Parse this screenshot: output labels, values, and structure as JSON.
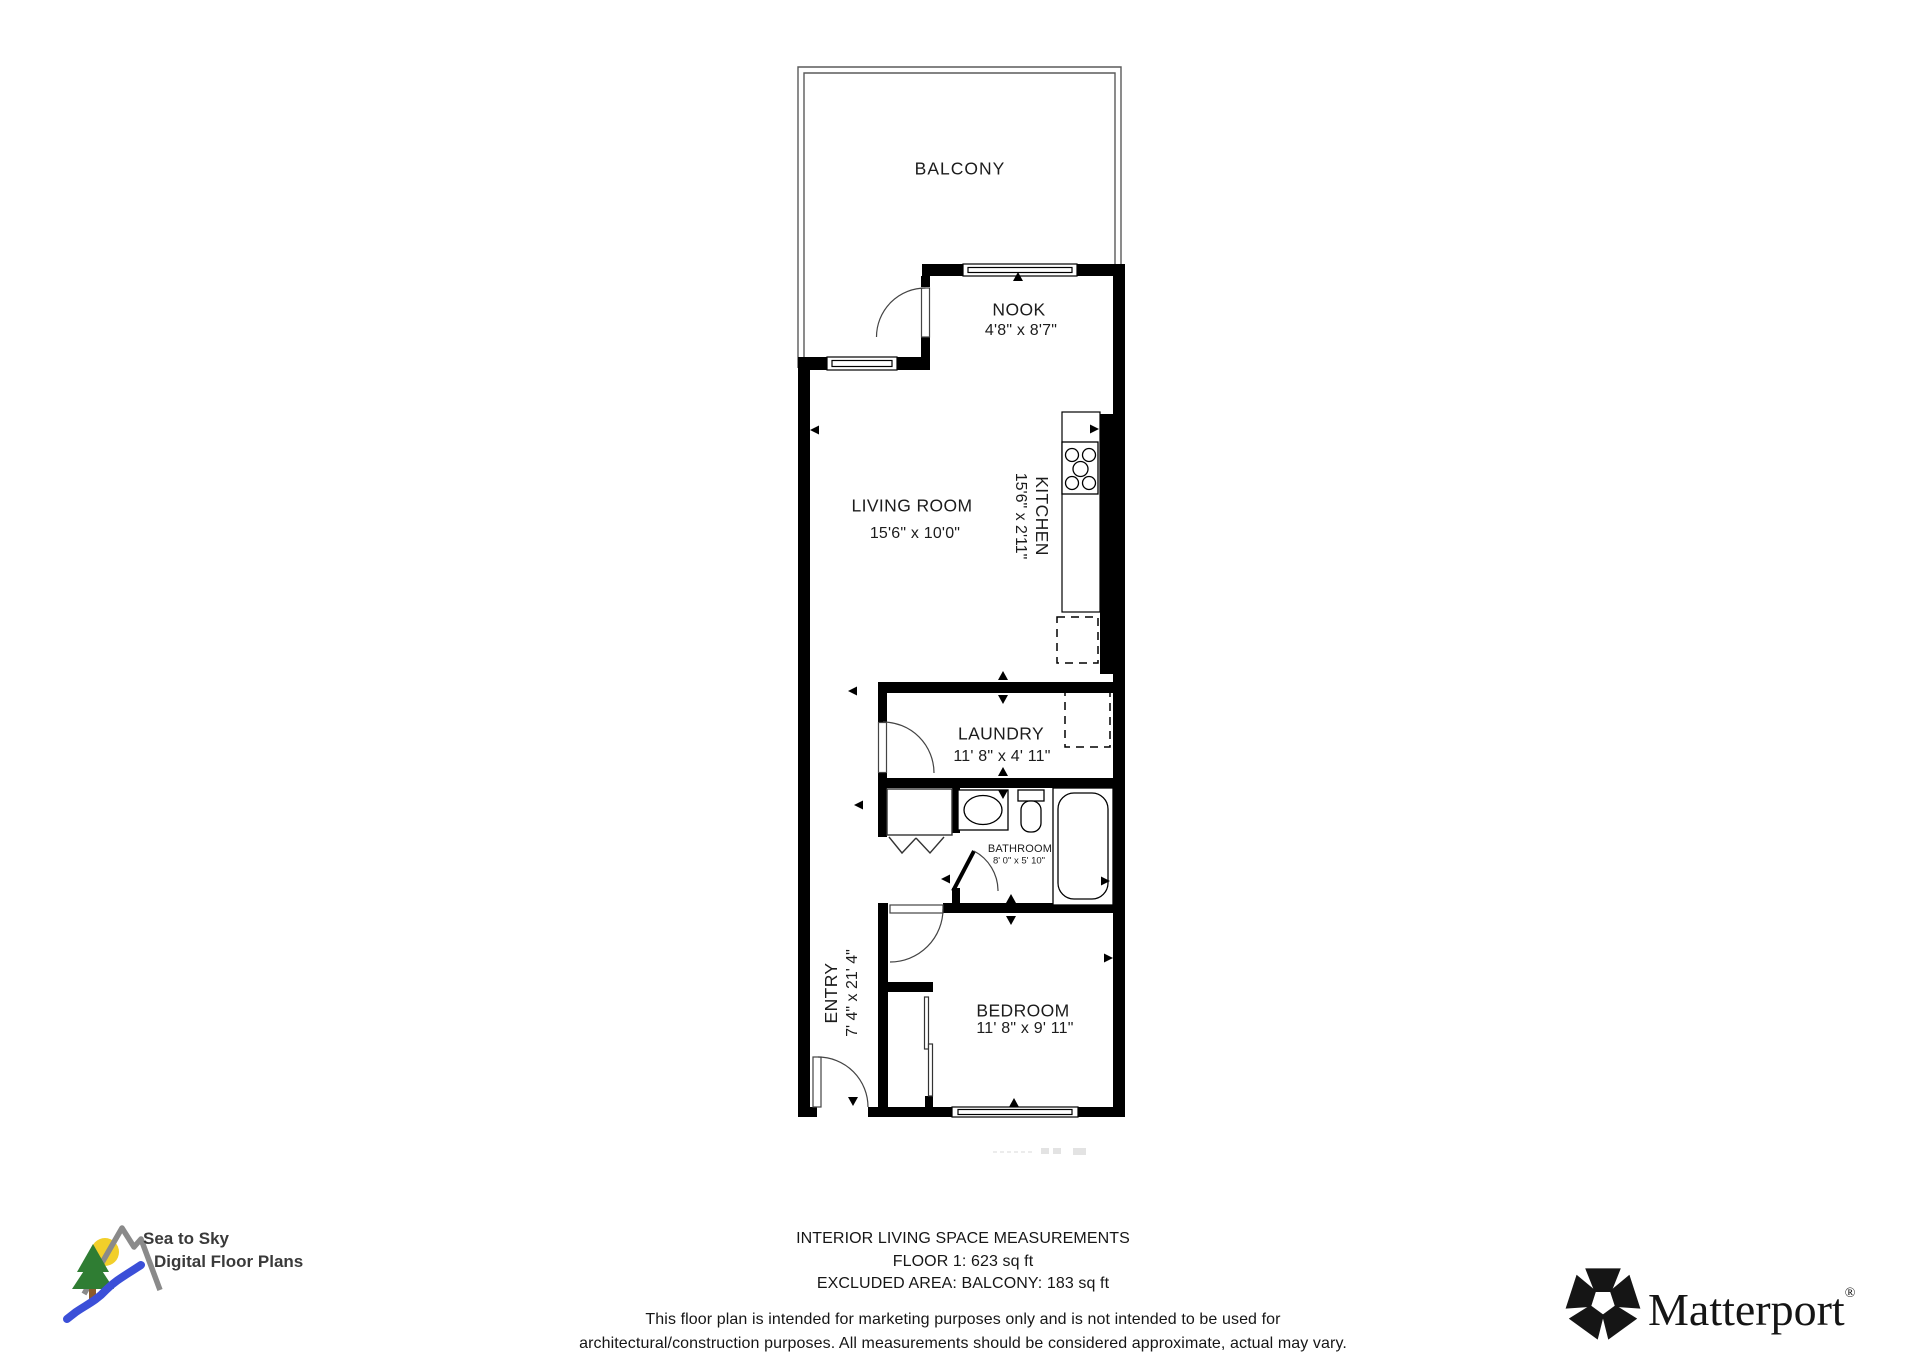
{
  "rooms": [
    {
      "name": "BALCONY",
      "dims": ""
    },
    {
      "name": "NOOK",
      "dims": "4'8\" x 8'7\""
    },
    {
      "name": "LIVING ROOM",
      "dims": "15'6\" x 10'0\""
    },
    {
      "name": "KITCHEN",
      "dims": "15'6\" x 2'11\""
    },
    {
      "name": "LAUNDRY",
      "dims": "11' 8\" x 4' 11\""
    },
    {
      "name": "BATHROOM",
      "dims": "8' 0\" x 5' 10\""
    },
    {
      "name": "ENTRY",
      "dims": "7' 4\" x 21' 4\""
    },
    {
      "name": "BEDROOM",
      "dims": "11' 8\" x 9' 11\""
    }
  ],
  "footer": {
    "measurements_line1": "INTERIOR LIVING SPACE MEASUREMENTS",
    "measurements_line2": "FLOOR 1: 623 sq ft",
    "measurements_line3": "EXCLUDED AREA: BALCONY: 183 sq ft",
    "disclaimer_line1": "This floor plan is intended for marketing purposes only and is not intended to be used for",
    "disclaimer_line2": "architectural/construction purposes. All measurements should be considered approximate, actual may vary."
  },
  "branding": {
    "sea_to_sky_line1": "Sea to Sky",
    "sea_to_sky_line2": "Digital Floor Plans",
    "matterport_name": "Matterport",
    "matterport_registered": "®"
  },
  "colors": {
    "walls": "#000000",
    "balcony_railing": "#5a5a5a",
    "text": "#1c1c1c",
    "logo_sun": "#f2cf2a",
    "logo_tree": "#2f7d33",
    "logo_trunk": "#8b5a2b",
    "logo_river": "#3b4fd8",
    "logo_mountain": "#8a8a8a",
    "matterport_black": "#151515"
  }
}
